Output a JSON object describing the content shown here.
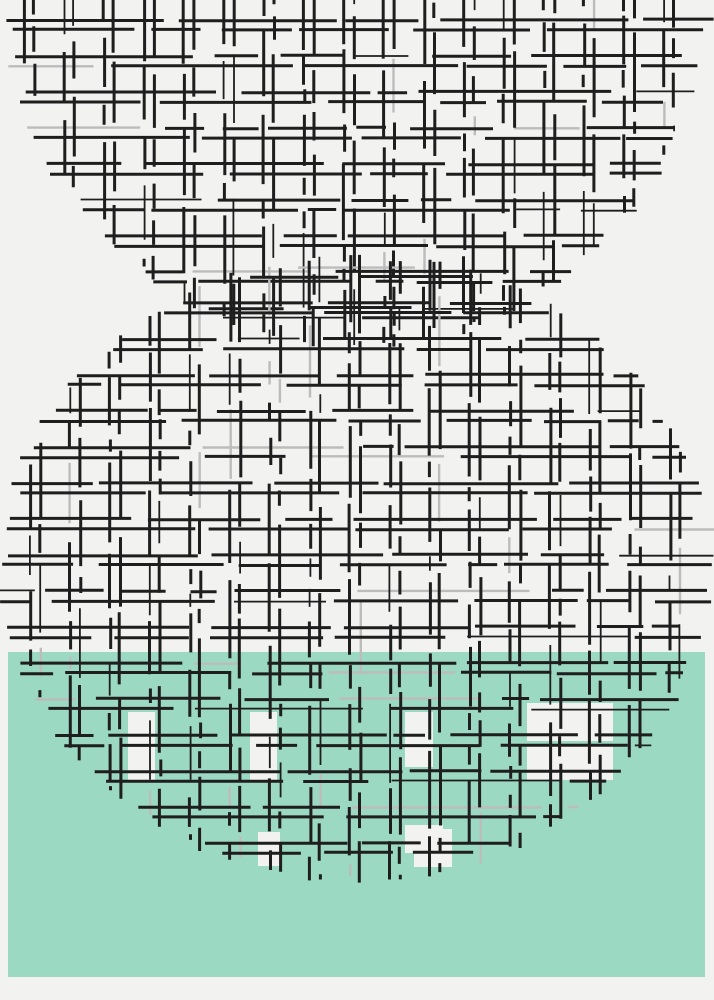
{
  "scene": {
    "canvas": {
      "width": 714,
      "height": 1000,
      "background_color": "#f2f2f1"
    },
    "band": {
      "x": 8,
      "y": 652,
      "width": 697,
      "height": 325,
      "color": "#9cd9c3"
    },
    "grid": {
      "ink_color": "#1e1e1e",
      "faint_ink_color": "#bcbcbc",
      "stroke_width": 3,
      "thin_stroke_width": 1.8,
      "faint_stroke_width": 2.4,
      "spacing_x": 40,
      "spacing_y": 36,
      "pair_gap": 10,
      "seed": 7
    },
    "shapes": [
      {
        "name": "top-grid-circle",
        "cx": 357,
        "cy": -8,
        "rx": 342,
        "ry": 348,
        "phase_x": 24,
        "phase_y": 20
      },
      {
        "name": "bottom-grid-circle",
        "cx": 357,
        "cy": 568,
        "rx": 345,
        "ry": 305,
        "phase_x": 30,
        "phase_y": 15
      }
    ],
    "white_cells": {
      "color": "#f2f2f1",
      "rects": [
        [
          128,
          712,
          27,
          68
        ],
        [
          250,
          712,
          27,
          68
        ],
        [
          405,
          712,
          28,
          55
        ],
        [
          527,
          703,
          86,
          38
        ],
        [
          527,
          744,
          86,
          36
        ],
        [
          405,
          825,
          38,
          28
        ],
        [
          258,
          832,
          22,
          34
        ],
        [
          414,
          829,
          38,
          38
        ]
      ]
    }
  }
}
